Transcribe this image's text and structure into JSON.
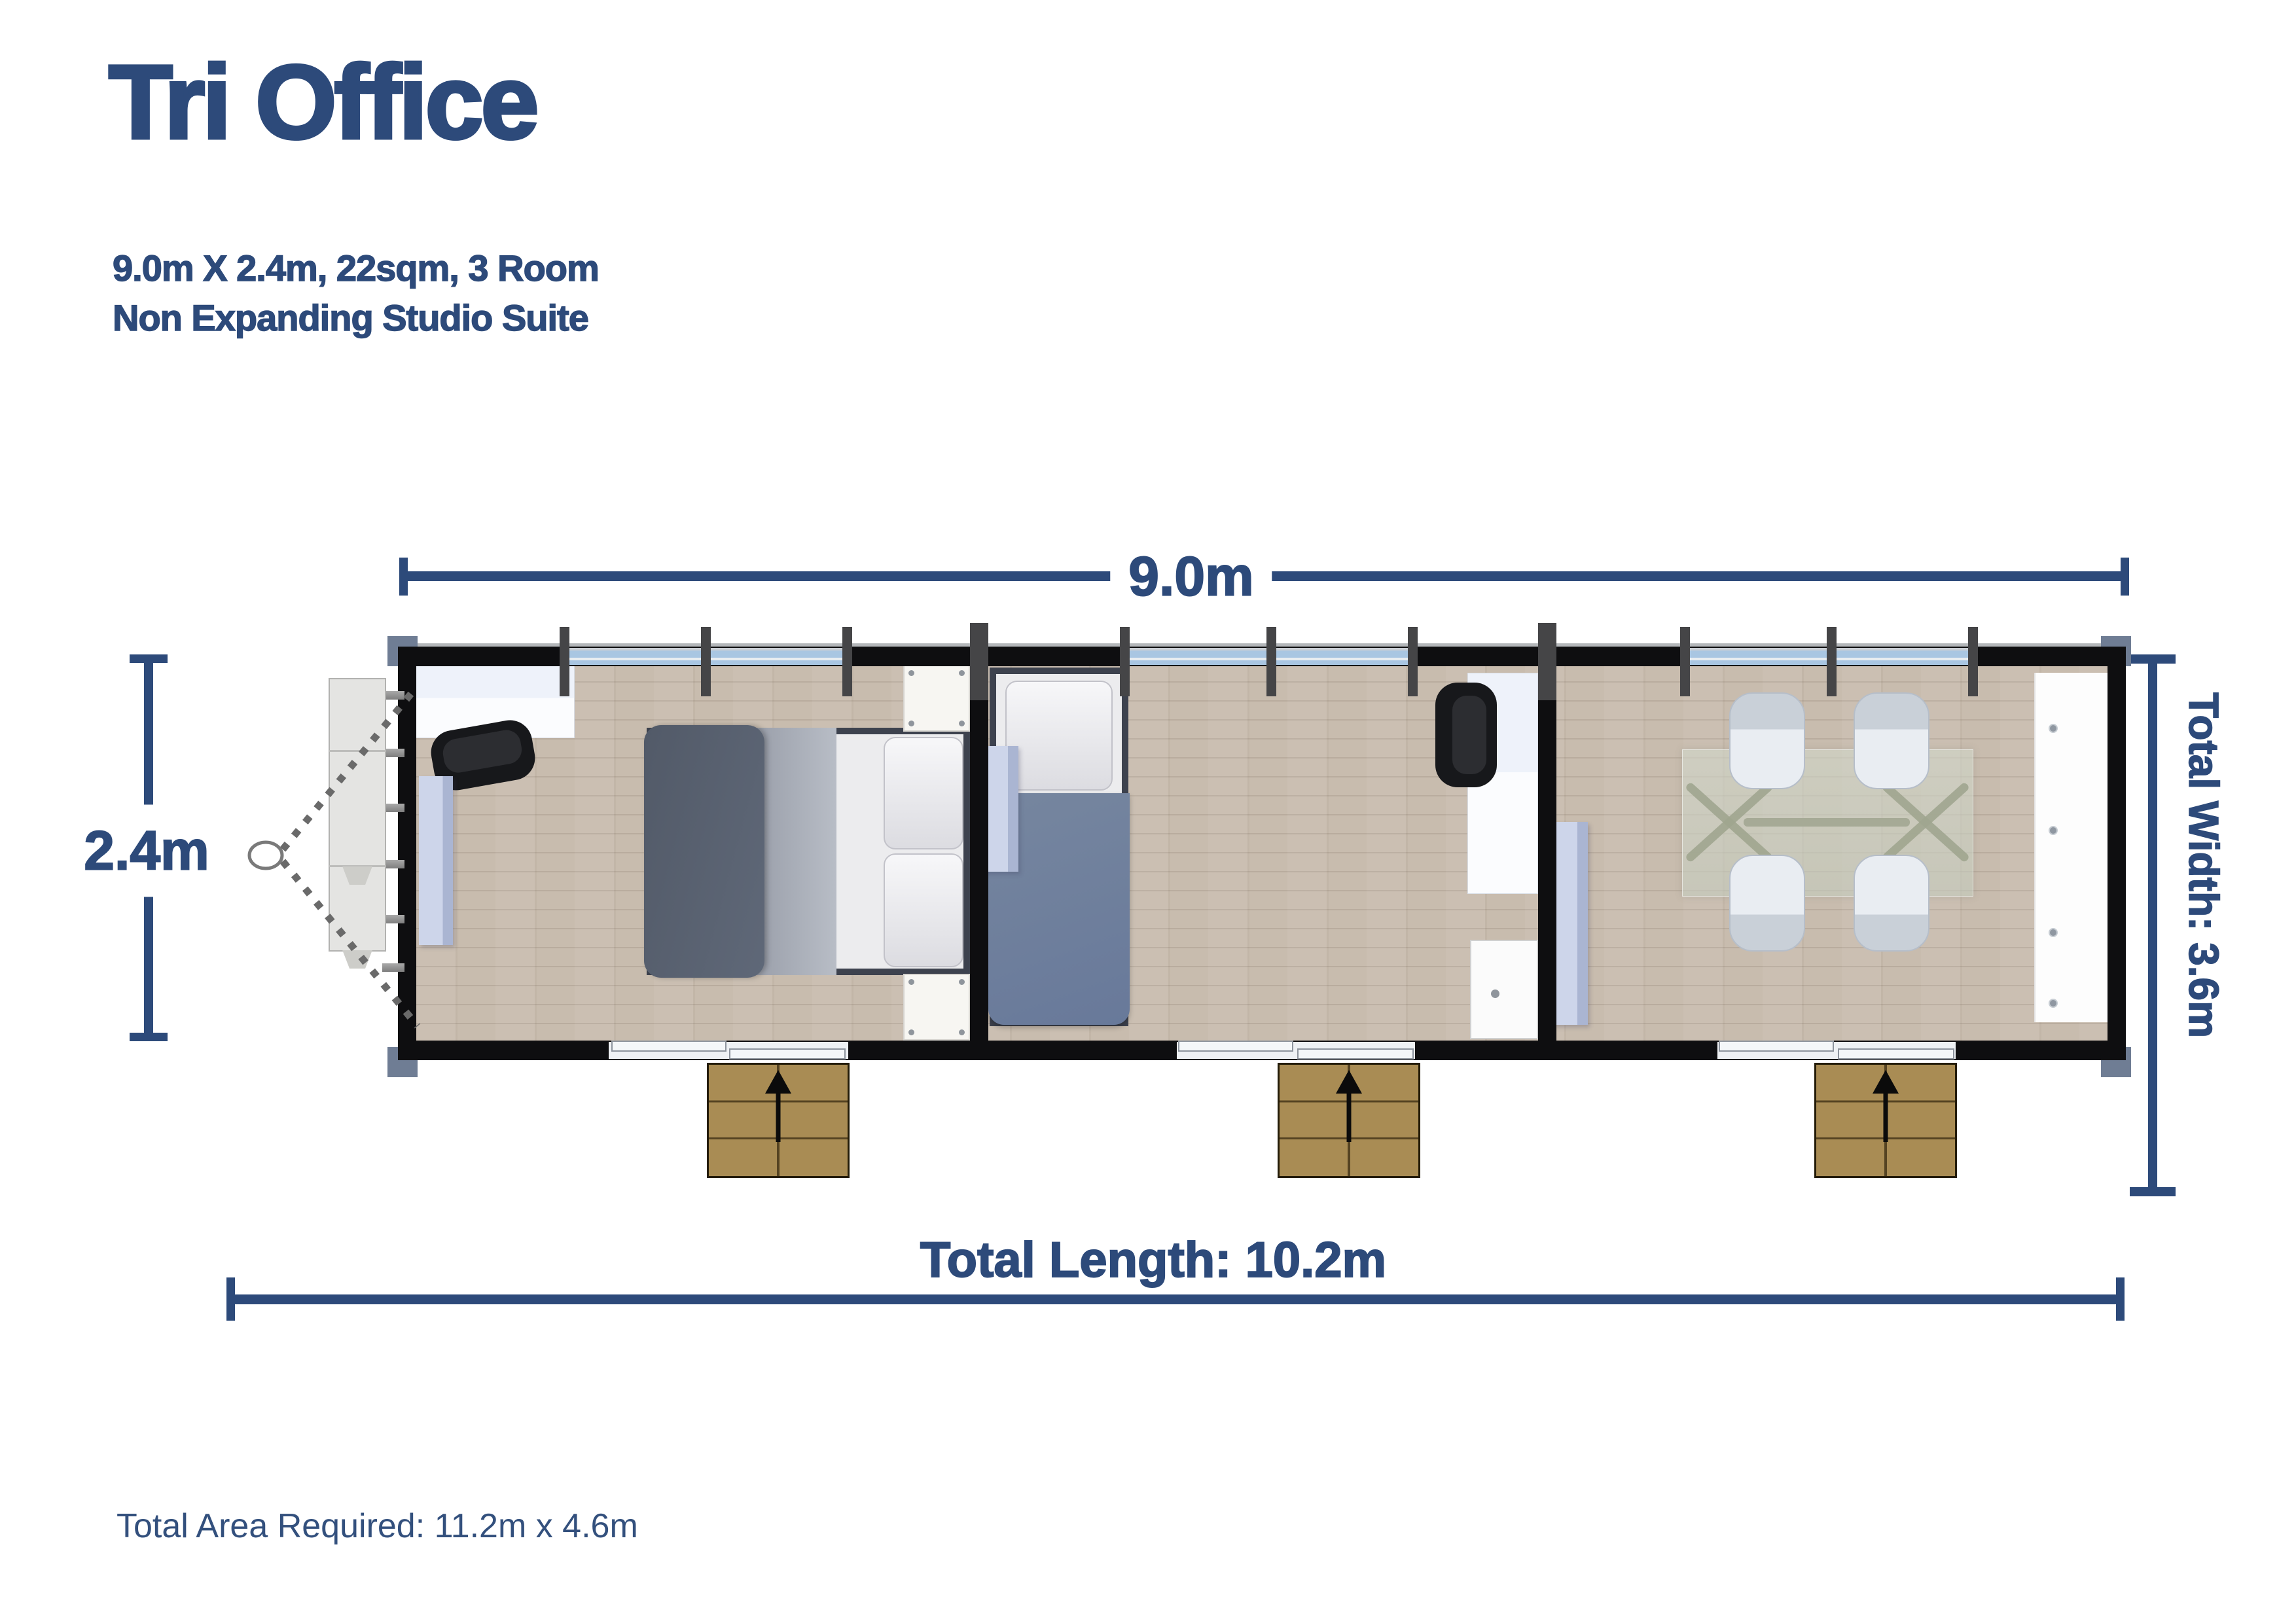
{
  "header": {
    "title": "Tri Office",
    "subtitle_line1": "9.0m X 2.4m, 22sqm, 3 Room",
    "subtitle_line2": "Non Expanding Studio Suite"
  },
  "dimensions": {
    "top_length": "9.0m",
    "unit_width": "2.4m",
    "total_width": "Total Width: 3.6m",
    "total_length": "Total Length: 10.2m"
  },
  "footer": {
    "total_area": "Total Area Required: 11.2m x 4.6m"
  },
  "plan": {
    "room_count": 3,
    "entrance_count": 3,
    "window_count": 3
  },
  "colors": {
    "accent_blue": "#2d4a7a",
    "wall_black": "#0e0e10",
    "window_blue": "#a9c6e2",
    "floor_beige": "#c8bcae",
    "step_tan": "#a98c54",
    "panel_lavender": "#c3cce3",
    "glass_table": "#cfd5c6"
  }
}
